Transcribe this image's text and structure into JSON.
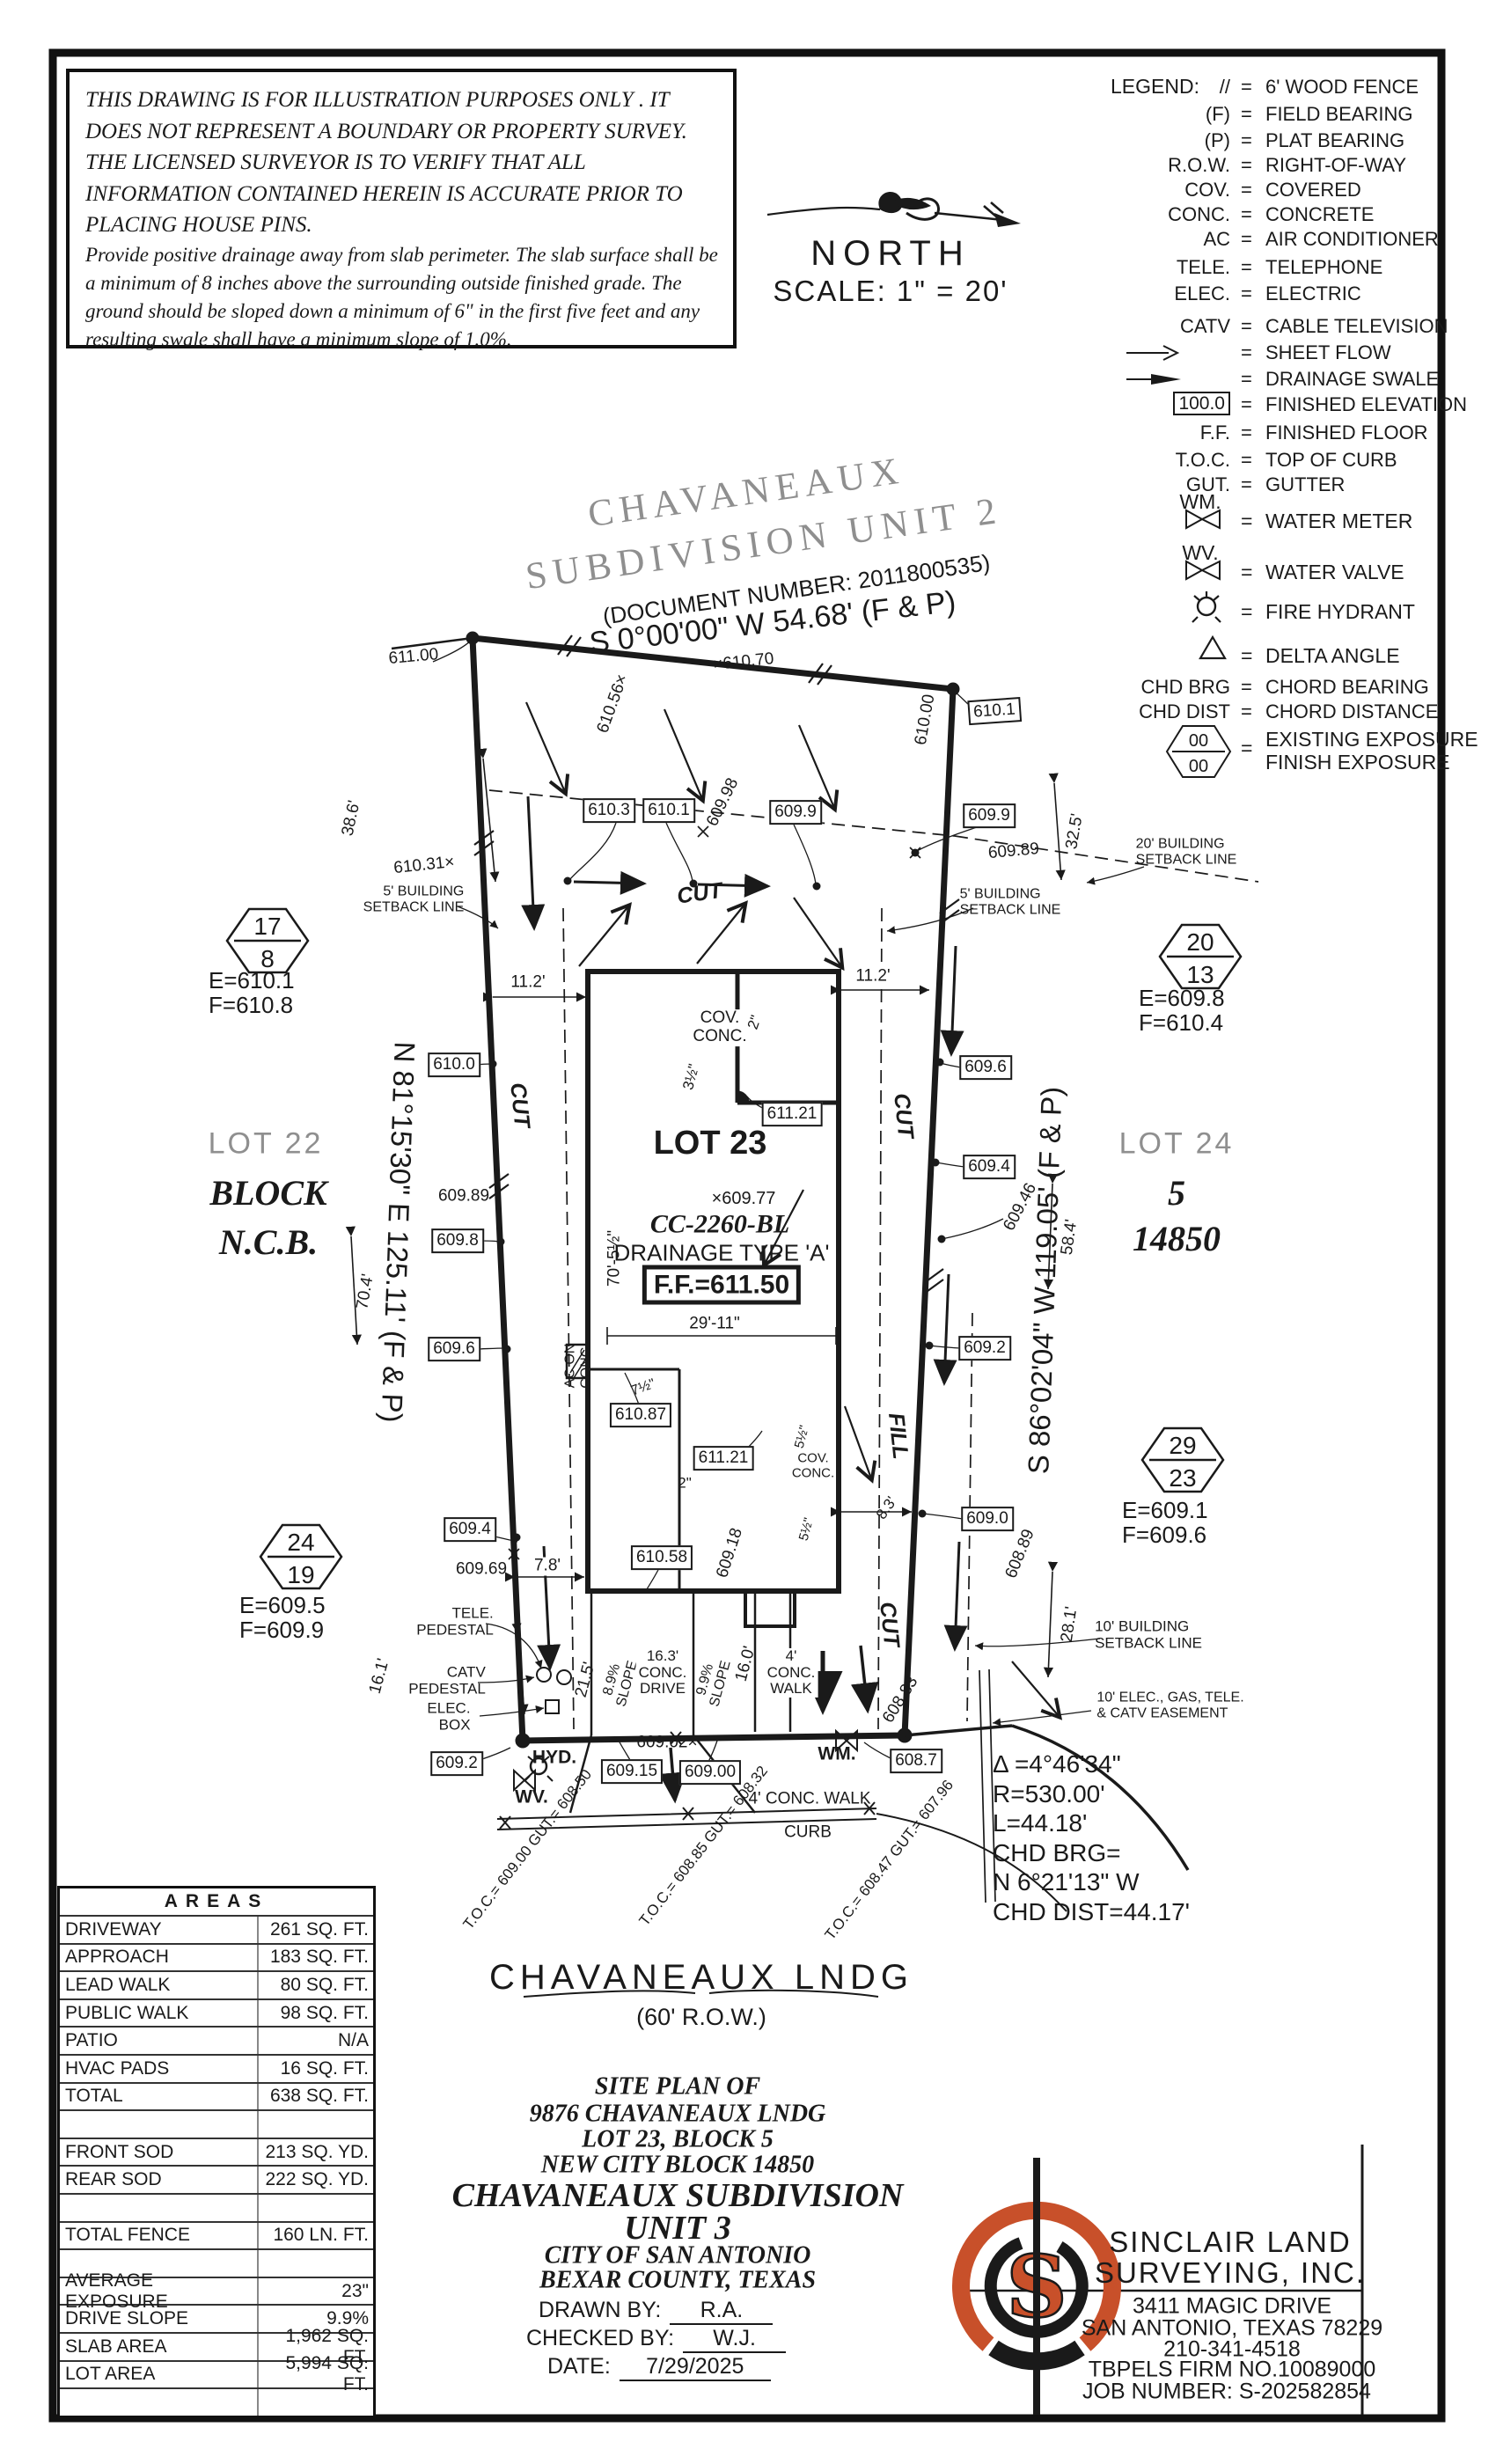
{
  "colors": {
    "ink": "#1a1a1a",
    "gray": "#8f8f8f",
    "orange": "#c8502a"
  },
  "disclaimer": {
    "p1": "THIS DRAWING IS FOR ILLUSTRATION PURPOSES ONLY . IT DOES\nNOT REPRESENT A BOUNDARY OR PROPERTY SURVEY. THE\nLICENSED SURVEYOR IS TO VERIFY THAT ALL INFORMATION\nCONTAINED HEREIN IS ACCURATE PRIOR TO PLACING HOUSE PINS.",
    "p2": "Provide positive drainage away from slab perimeter. The slab surface shall be a\nminimum of 8 inches above the surrounding outside finished grade. The ground should be\nsloped down a minimum of 6\" in the first five feet and any resulting swale shall have a\nminimum slope of 1.0%."
  },
  "north": {
    "label": "NORTH",
    "scale": "SCALE:  1\" = 20'"
  },
  "legend": {
    "title": "LEGEND:",
    "eq": "=",
    "hex_top": "00",
    "hex_bot": "00",
    "rows": [
      {
        "s": "//",
        "d": "6' WOOD FENCE"
      },
      {
        "s": "(F)",
        "d": "FIELD BEARING"
      },
      {
        "s": "(P)",
        "d": "PLAT BEARING"
      },
      {
        "s": "R.O.W.",
        "d": "RIGHT-OF-WAY"
      },
      {
        "s": "COV.",
        "d": "COVERED"
      },
      {
        "s": "CONC.",
        "d": "CONCRETE"
      },
      {
        "s": "AC",
        "d": "AIR CONDITIONER"
      },
      {
        "s": "TELE.",
        "d": "TELEPHONE"
      },
      {
        "s": "ELEC.",
        "d": "ELECTRIC"
      },
      {
        "s": "CATV",
        "d": "CABLE TELEVISION"
      },
      {
        "s": "",
        "d": "SHEET FLOW"
      },
      {
        "s": "",
        "d": "DRAINAGE SWALE"
      },
      {
        "s": "100.0",
        "d": "FINISHED ELEVATION"
      },
      {
        "s": "F.F.",
        "d": "FINISHED FLOOR"
      },
      {
        "s": "T.O.C.",
        "d": "TOP OF CURB"
      },
      {
        "s": "GUT.",
        "d": "GUTTER"
      },
      {
        "s": "WM.",
        "d": "WATER METER"
      },
      {
        "s": "WV.",
        "d": "WATER VALVE"
      },
      {
        "s": "",
        "d": "FIRE HYDRANT"
      },
      {
        "s": "",
        "d": "DELTA ANGLE"
      },
      {
        "s": "CHD BRG",
        "d": "CHORD BEARING"
      },
      {
        "s": "CHD DIST",
        "d": "CHORD DISTANCE"
      },
      {
        "s": "",
        "d": "EXISTING EXPOSURE\nFINISH EXPOSURE"
      }
    ]
  },
  "header": {
    "sub1": "CHAVANEAUX",
    "sub2": "SUBDIVISION  UNIT  2",
    "doc": "(DOCUMENT NUMBER:  2011800535)",
    "brg": "S 0°00'00\" W  54.68'  (F & P)"
  },
  "plan": {
    "brgL": "N 81°15'30\" E  125.11'  (F & P)",
    "brgR": "S 86°02'04\" W  119.05'  (F & P)",
    "lots": {
      "lot22": "LOT 22",
      "block": "BLOCK",
      "ncb": "N.C.B.",
      "lot23": "LOT 23",
      "lot24": "LOT 24",
      "blk5": "5",
      "ncb14850": "14850"
    },
    "house": {
      "spot": "×609.77",
      "cc": "CC-2260-BL",
      "drain": "DRAINAGE  TYPE  'A'",
      "ff": "F.F.=611.50",
      "cov": "COV.\nCONC.",
      "ac": "AC ON\nCONC."
    },
    "hex": {
      "h17": {
        "t": "17",
        "b": "8",
        "e": "E=610.1",
        "f": "F=610.8"
      },
      "h20": {
        "t": "20",
        "b": "13",
        "e": "E=609.8",
        "f": "F=610.4"
      },
      "h29": {
        "t": "29",
        "b": "23",
        "e": "E=609.1",
        "f": "F=609.6"
      },
      "h24": {
        "t": "24",
        "b": "19",
        "e": "E=609.5",
        "f": "F=609.9"
      }
    },
    "elev": {
      "s611_00": "611.00",
      "s610_56": "610.56×",
      "s610_70": "×610.70",
      "s610_00": "610.00",
      "b610_1": "610.1",
      "b610_3": "610.3",
      "s609_98": "609.98",
      "b609_9": "609.9",
      "s609_89": "609.89",
      "s610_31": "610.31×",
      "b610_0": "610.0",
      "b609_8": "609.8",
      "b609_6": "609.6",
      "b609_4": "609.4",
      "b609_2": "609.2",
      "b609_0": "609.0",
      "b610_87": "610.87",
      "b611_21": "611.21",
      "b610_58": "610.58",
      "s609_18": "609.18",
      "s609_46": "609.46",
      "s608_89": "608.89",
      "s608_83": "608.83",
      "s609_69": "609.69",
      "s609_02": "609.02×",
      "b609_15": "609.15",
      "b609_00": "609.00",
      "b608_7": "608.7"
    },
    "dims": {
      "d38_6": "38.6'",
      "d32_5": "32.5'",
      "d70_4": "70.4'",
      "d58_4": "58.4'",
      "d28_1": "28.1'",
      "d16_1": "16.1'",
      "d11_2": "11.2'",
      "d7_8": "7.8'",
      "d8_3": "8.3'",
      "d21_5": "21.5'",
      "d16_0": "16.0'",
      "d29_11": "29'-11\"",
      "d70_5": "70'-5½\"",
      "half3": "3½\"",
      "half7": "7½\"",
      "half5": "5½\"",
      "two_in": "2\""
    },
    "cf": {
      "cut": "CUT",
      "fill": "FILL"
    },
    "sb": {
      "sb5": "5' BUILDING\nSETBACK LINE",
      "sb20": "20' BUILDING\nSETBACK LINE",
      "sb10": "10' BUILDING\nSETBACK LINE",
      "ease": "10' ELEC., GAS, TELE.\n& CATV EASEMENT"
    },
    "site": {
      "tele": "TELE.\nPEDESTAL",
      "catv": "CATV\nPEDESTAL",
      "elec": "ELEC.\nBOX",
      "hyd": "HYD.",
      "wv": "WV.",
      "wm": "WM.",
      "slope89": "8.9%\nSLOPE",
      "slope99": "9.9%\nSLOPE",
      "drive": "16.3'\nCONC.\nDRIVE",
      "walkv": "4'\nCONC.\nWALK",
      "walkh": "4' CONC. WALK",
      "curb": "CURB",
      "toc1": "T.O.C.= 609.00\nGUT.= 608.50",
      "toc2": "T.O.C.= 608.85\nGUT.= 608.32",
      "toc3": "T.O.C.= 608.47\nGUT.= 607.96"
    },
    "curve": {
      "text": "Δ =4°46'34\"\nR=530.00'\nL=44.18'\nCHD BRG=\nN 6°21'13\" W\nCHD DIST=44.17'"
    }
  },
  "street": {
    "name": "CHAVANEAUX  LNDG",
    "row": "(60' R.O.W.)"
  },
  "areas": {
    "title": "AREAS",
    "rows": [
      {
        "l": "DRIVEWAY",
        "v": "261 SQ. FT."
      },
      {
        "l": "APPROACH",
        "v": "183 SQ. FT."
      },
      {
        "l": "LEAD WALK",
        "v": "80 SQ. FT."
      },
      {
        "l": "PUBLIC WALK",
        "v": "98 SQ. FT."
      },
      {
        "l": "PATIO",
        "v": "N/A"
      },
      {
        "l": "HVAC PADS",
        "v": "16 SQ. FT."
      },
      {
        "l": "TOTAL",
        "v": "638 SQ. FT."
      },
      {
        "l": "",
        "v": ""
      },
      {
        "l": "FRONT SOD",
        "v": "213 SQ. YD."
      },
      {
        "l": "REAR SOD",
        "v": "222 SQ. YD."
      },
      {
        "l": "",
        "v": ""
      },
      {
        "l": "TOTAL FENCE",
        "v": "160 LN. FT."
      },
      {
        "l": "",
        "v": ""
      },
      {
        "l": "AVERAGE EXPOSURE",
        "v": "23\""
      },
      {
        "l": "DRIVE SLOPE",
        "v": "9.9%"
      },
      {
        "l": "SLAB AREA",
        "v": "1,962 SQ. FT."
      },
      {
        "l": "LOT AREA",
        "v": "5,994 SQ. FT."
      },
      {
        "l": "",
        "v": ""
      }
    ]
  },
  "titleblock": {
    "l1": "SITE PLAN OF",
    "l2": "9876 CHAVANEAUX LNDG",
    "l3": "LOT 23, BLOCK 5",
    "l4": "NEW CITY BLOCK 14850",
    "l5": "CHAVANEAUX SUBDIVISION",
    "l6": "UNIT 3",
    "l7": "CITY OF SAN ANTONIO",
    "l8": "BEXAR COUNTY, TEXAS",
    "drawn_label": "DRAWN BY:",
    "drawn": "R.A.",
    "checked_label": "CHECKED BY:",
    "checked": "W.J.",
    "date_label": "DATE:",
    "date": "7/29/2025"
  },
  "firm": {
    "n1": "SINCLAIR  LAND",
    "n2": "SURVEYING,  INC.",
    "a1": "3411 MAGIC DRIVE",
    "a2": "SAN ANTONIO, TEXAS 78229",
    "a3": "210-341-4518",
    "a4": "TBPELS FIRM NO.10089000",
    "a5": "JOB NUMBER: S-202582854",
    "logo_s": "S"
  }
}
